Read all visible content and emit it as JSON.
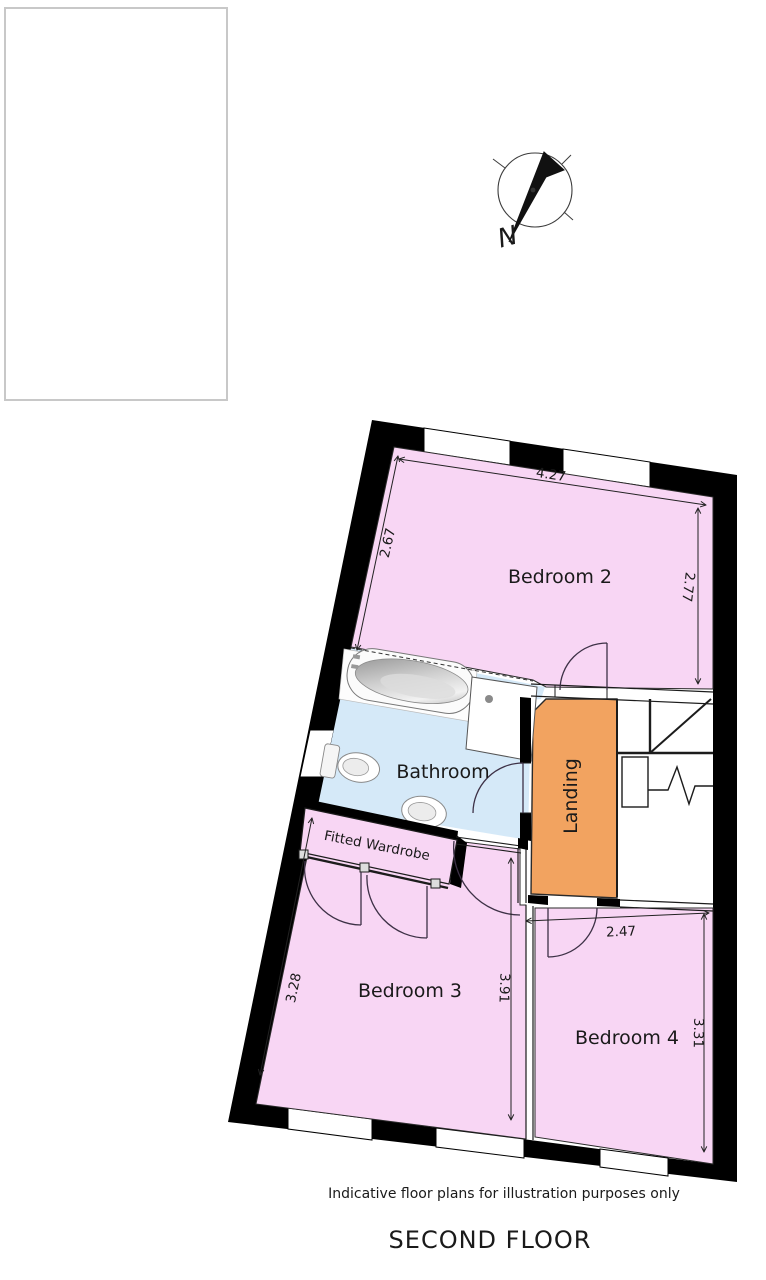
{
  "labels": {
    "disclaimer": "Indicative floor plans for illustration purposes only",
    "floor_title": "SECOND FLOOR"
  },
  "compass": {
    "north": "N"
  },
  "rooms": {
    "bedroom2": {
      "label": "Bedroom 2",
      "width": "4.27",
      "left": "2.67",
      "right": "2.77"
    },
    "bathroom": {
      "label": "Bathroom"
    },
    "landing": {
      "label": "Landing"
    },
    "wardrobe": {
      "label": "Fitted Wardrobe"
    },
    "bedroom3": {
      "label": "Bedroom 3",
      "left": "3.28",
      "right": "3.91"
    },
    "bedroom4": {
      "label": "Bedroom 4",
      "width": "2.47",
      "right": "3.31"
    }
  },
  "colors": {
    "room_pink": "#F8D6F4",
    "bathroom_blue": "#D5E9F8",
    "landing_orange": "#F2A360",
    "wall_black": "#000000"
  }
}
